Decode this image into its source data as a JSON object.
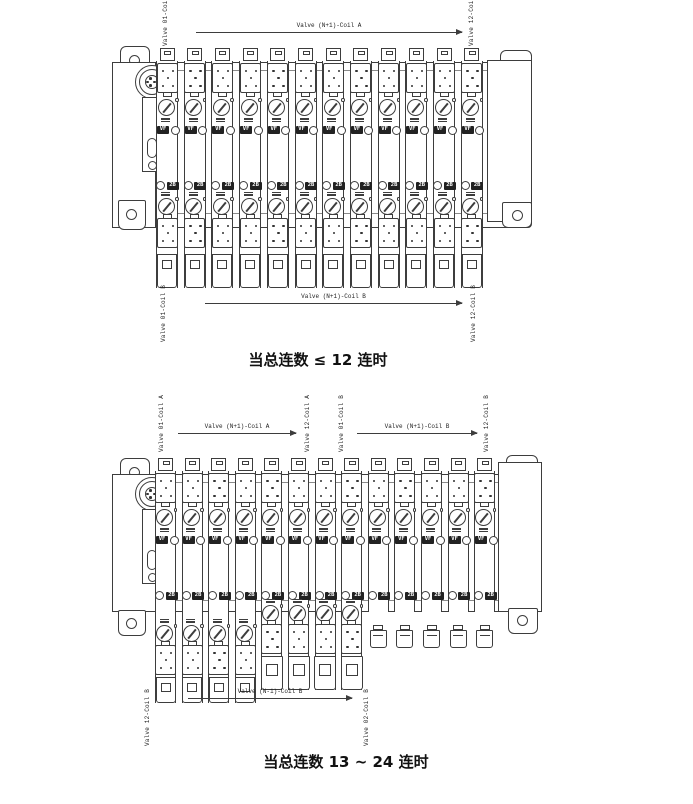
{
  "page": {
    "bg": "#ffffff",
    "line_color": "#3d3d3d",
    "label_color": "#222222",
    "caption_color": "#111111"
  },
  "diagrams": [
    {
      "id": "up-to-12",
      "caption": "当总连数 ≤ 12 连时",
      "stations": 12,
      "top_labels": {
        "left": "Valve 01-Coil A",
        "arrow": "Valve (N+1)-Coil A",
        "right": "Valve 12-Coil A"
      },
      "bottom_labels": {
        "left": "Valve 01-Coil B",
        "arrow": "Valve (N+1)-Coil B",
        "right": "Valve 12-Coil B"
      },
      "slice_badges": {
        "top": "VF",
        "bottom": "2B"
      },
      "bottom_styles": [
        {
          "style": "full",
          "count": 12
        }
      ],
      "icons": [
        "m12-connector",
        "mounting-hole",
        "manual-override-dial",
        "coil-connector-pins",
        "blank-plug"
      ]
    },
    {
      "id": "13-to-24",
      "caption": "当总连数 13 ~ 24 连时",
      "stations": 13,
      "top_labels": {
        "a_left": "Valve 01-Coil A",
        "a_arrow": "Valve (N+1)-Coil A",
        "a_right": "Valve 12-Coil A",
        "b_left": "Valve 01-Coil B",
        "b_arrow": "Valve (N+1)-Coil B",
        "b_right": "Valve 12-Coil B"
      },
      "bottom_labels": {
        "left": "Valve 12-Coil B",
        "arrow": "Valve (N-1)-Coil B",
        "right": "Valve 02-Coil B"
      },
      "slice_badges": {
        "top": "VF",
        "bottom": "2B"
      },
      "bottom_styles": [
        {
          "style": "deep",
          "count": 4
        },
        {
          "style": "mid",
          "count": 4
        },
        {
          "style": "stub",
          "count": 5
        }
      ],
      "icons": [
        "m12-connector",
        "mounting-hole",
        "manual-override-dial",
        "coil-connector-pins",
        "blank-plug"
      ]
    }
  ]
}
